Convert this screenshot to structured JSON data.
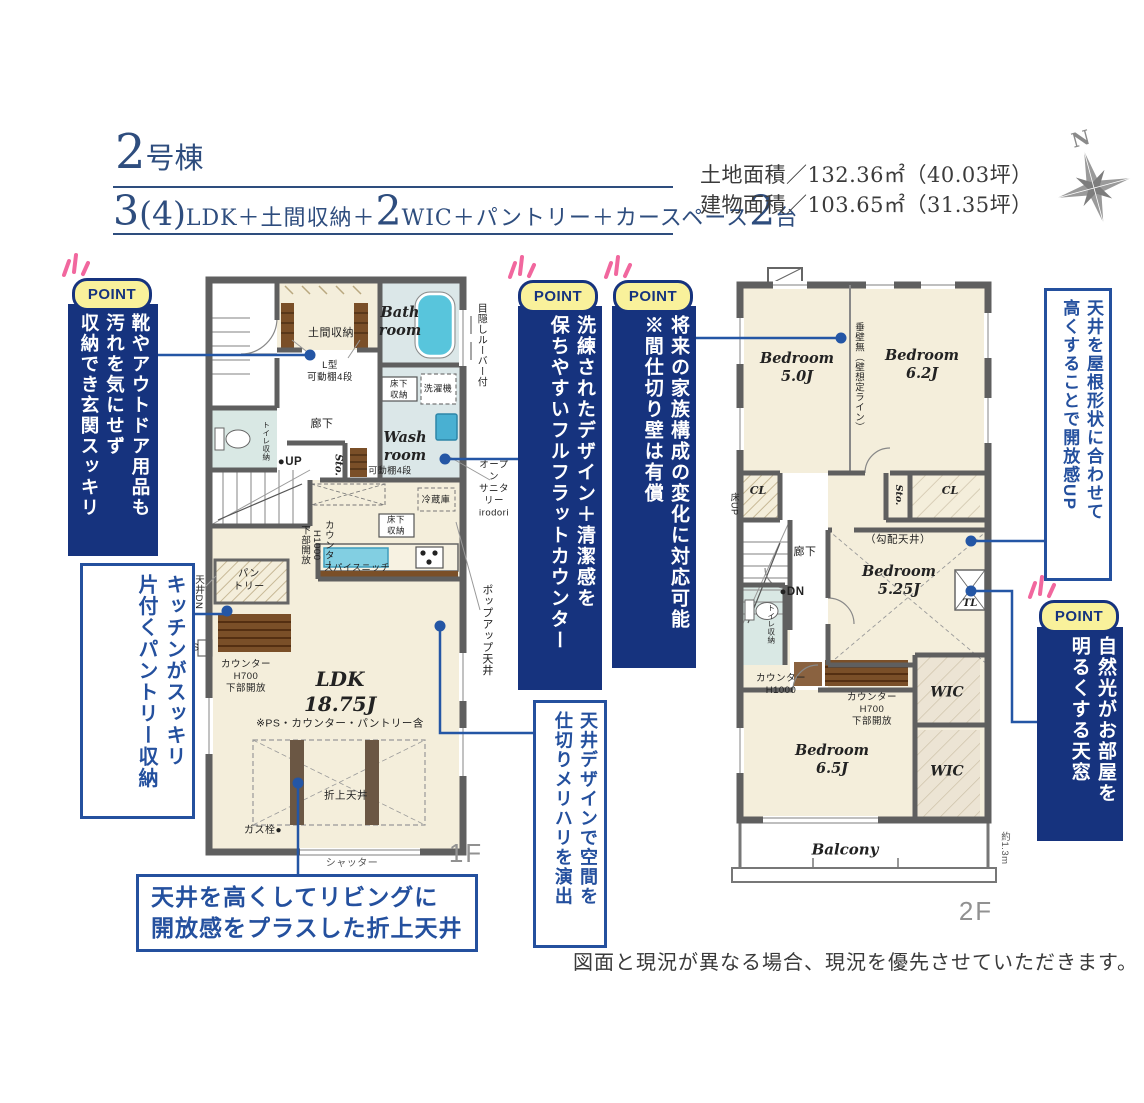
{
  "header": {
    "building_no_num": "2",
    "building_no_suffix": "号棟",
    "spec": {
      "n1": "3",
      "p1": "(4)",
      "s1": "LDK＋土間収納＋",
      "n2": "2",
      "s2": "WIC＋パントリー＋カースペース",
      "n3": "2",
      "s3": "台"
    },
    "land_area": "土地面積／132.36㎡（40.03坪）",
    "building_area": "建物面積／103.65㎡（31.35坪）",
    "compass_n": "N"
  },
  "points": [
    {
      "badge": "POINT",
      "text": "靴やアウトドア用品も\n汚れを気にせず\n収納でき玄関スッキリ"
    },
    {
      "badge": "POINT",
      "text": "洗練されたデザイン＋清潔感を\n保ちやすいフルフラットカウンター"
    },
    {
      "badge": "POINT",
      "text": "将来の家族構成の変化に対応可能\n※間仕切り壁は有償"
    },
    {
      "badge": "POINT",
      "text": "自然光がお部屋を\n明るくする天窓"
    }
  ],
  "notes": {
    "pantry": "キッチンがスッキリ\n片付くパントリー収納",
    "ceiling_design": "天井デザインで空間を\n仕切りメリハリを演出",
    "roof_ceiling": "天井を屋根形状に合わせて\n高くすることで開放感UP",
    "coffered": "天井を高くしてリビングに\n開放感をプラスした折上天井"
  },
  "floor1": {
    "name": "1F",
    "labels": {
      "doma": "土間収納",
      "doma_sub": "L型\n可動棚4段",
      "bath": "Bath\nroom",
      "underfloor1": "床下\n収納",
      "washer": "洗濯機",
      "wash": "Wash\nroom",
      "hall": "廊下",
      "toilet_sto": "トイレ収納",
      "up": "●UP",
      "sto": "Sto.",
      "shelf4": "可動棚4段",
      "counter_h1000": "カウンター\nH1000\n下部開放",
      "fridge": "冷蔵庫",
      "underfloor2": "床下\n収納",
      "spice": "スパイスニッチ",
      "pantry": "パン\nトリー",
      "ceiling_dn": "天井DN",
      "ps": "PS",
      "counter_h700": "カウンター\nH700\n下部開放",
      "ldk": "LDK\n18.75J",
      "ldk_note": "※PS・カウンター・パントリー含",
      "coffered": "折上天井",
      "gas": "ガス栓●",
      "shutter": "シャッター",
      "louver": "目隠しルーバー付",
      "popup": "ポップアップ天井",
      "sanitary": "オープン\nサニタリー\nirodori"
    }
  },
  "floor2": {
    "name": "2F",
    "labels": {
      "bed1": "Bedroom\n5.0J",
      "bed2": "Bedroom\n6.2J",
      "no_wall": "垂壁無（壁想定ライン）",
      "floor_up": "床UP",
      "cl1": "CL",
      "sto": "Sto.",
      "cl2": "CL",
      "hall": "廊下",
      "dn": "●DN",
      "sloped": "（勾配天井）",
      "bed3": "Bedroom\n5.25J",
      "tl": "TL",
      "toilet_sto": "トイレ収納",
      "counter_h1000": "カウンター\nH1000",
      "counter_h700": "カウンター\nH700\n下部開放",
      "wic1": "WIC",
      "bed4": "Bedroom\n6.5J",
      "wic2": "WIC",
      "balcony": "Balcony",
      "depth": "約1.3m"
    }
  },
  "disclaimer": "図面と現況が異なる場合、現況を優先させていただきます。",
  "colors": {
    "navy": "#16337e",
    "blue": "#24509e",
    "yellow": "#f9f19b",
    "pink": "#f1679e",
    "line": "#2456a5",
    "wall": "#5f5f5f",
    "cream": "#f4eedb",
    "wet": "#dbe7e8",
    "tub": "#58c5dc"
  }
}
